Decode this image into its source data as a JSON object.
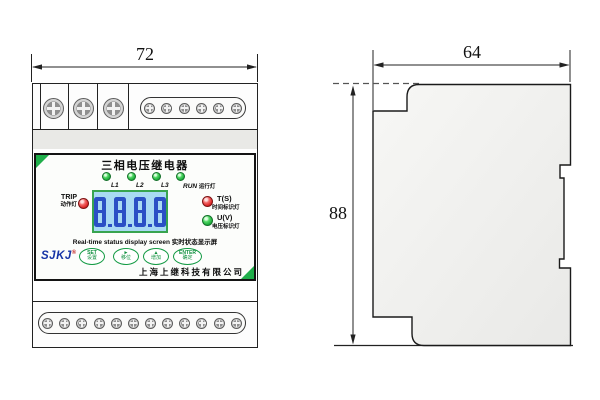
{
  "front_view": {
    "dimension_width": "72",
    "terminals": {
      "large_top_screws": 3,
      "grouped_top_screws": 6,
      "bottom_screws": 12
    },
    "panel": {
      "title": "三相电压继电器",
      "leds": [
        {
          "label": "L1"
        },
        {
          "label": "L2"
        },
        {
          "label": "L3"
        },
        {
          "label": "RUN",
          "sub": "运行灯"
        }
      ],
      "trip": {
        "label": "TRIP",
        "sub": "动作灯"
      },
      "display": {
        "value": "8.8.8.8",
        "caption": "Real-time status display screen 实时状态显示屏"
      },
      "indicators": [
        {
          "label": "T(S)",
          "sub": "时间标识灯",
          "color": "red"
        },
        {
          "label": "U(V)",
          "sub": "电压标识灯",
          "color": "green"
        }
      ],
      "logo": "SJKJ",
      "logo_mark": "®",
      "buttons": [
        {
          "top": "SET",
          "bottom": "设置"
        },
        {
          "top": "►",
          "bottom": "移位"
        },
        {
          "top": "▲",
          "bottom": "增加"
        },
        {
          "top": "ENTER",
          "bottom": "确定"
        }
      ],
      "company": "上海上继科技有限公司"
    }
  },
  "side_view": {
    "dimension_width": "64",
    "dimension_height": "88"
  },
  "colors": {
    "accent_green": "#1fae4a",
    "lcd_border_green": "#38a450",
    "lcd_background_blue": "#a9daf3",
    "lcd_digit_blue": "#2b50c5",
    "led_green": "#1daf3c",
    "led_red": "#dd2525",
    "logo_blue": "#1634a6",
    "line_color": "#222222"
  }
}
